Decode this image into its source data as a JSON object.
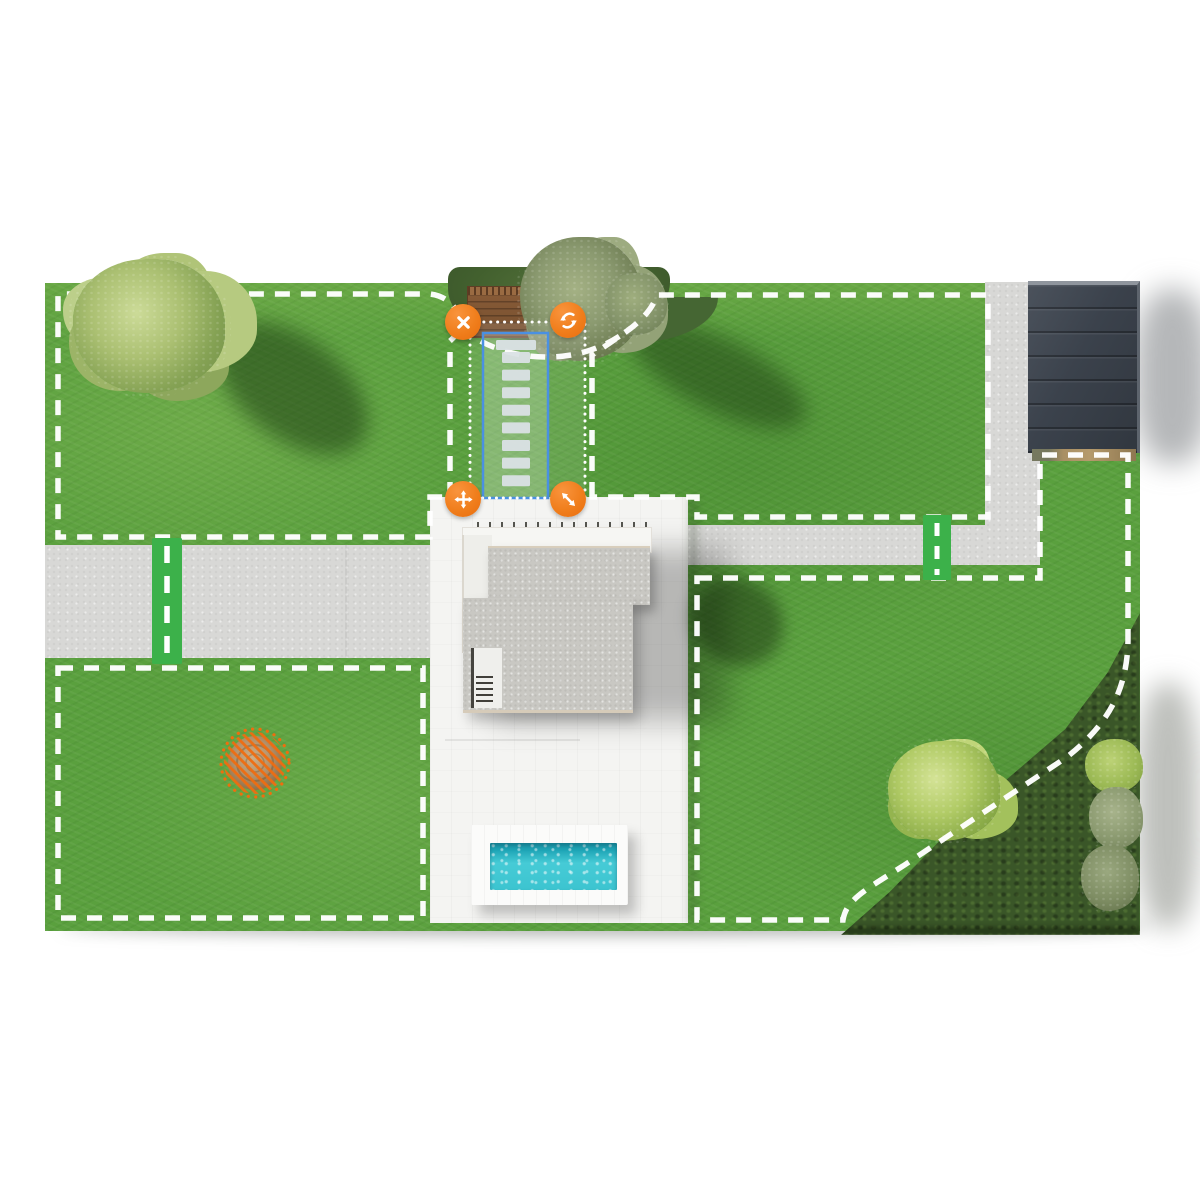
{
  "app": {
    "name": "robot-mower-garden-map",
    "view": "zone-editor"
  },
  "map": {
    "zones": [
      {
        "id": "zone-top-left",
        "type": "mowing-zone",
        "boundary_style": "white-dashed"
      },
      {
        "id": "zone-top-right",
        "type": "mowing-zone",
        "boundary_style": "white-dashed"
      },
      {
        "id": "zone-bottom-left",
        "type": "mowing-zone",
        "boundary_style": "white-dashed"
      },
      {
        "id": "zone-bottom-right",
        "type": "mowing-zone",
        "boundary_style": "white-dashed"
      }
    ],
    "passages": [
      {
        "id": "passage-west",
        "orientation": "vertical",
        "crosses": "left-walkway"
      },
      {
        "id": "passage-east",
        "orientation": "vertical",
        "crosses": "right-walkway"
      }
    ],
    "obstacle": {
      "id": "no-go-circle",
      "shape": "circle",
      "style": "orange-hatched"
    },
    "selection": {
      "id": "stepping-stone-zone",
      "shape": "rectangle",
      "stepping_stones": 9,
      "stone": {
        "x": 457,
        "y0": 69,
        "width": 28,
        "height": 11,
        "gap": 17.6,
        "top_width": 40
      },
      "handles": [
        {
          "icon": "close-icon",
          "action": "delete-zone"
        },
        {
          "icon": "rotate-icon",
          "action": "rotate-zone"
        },
        {
          "icon": "move-icon",
          "action": "move-zone"
        },
        {
          "icon": "resize-icon",
          "action": "resize-zone"
        }
      ]
    },
    "features": [
      "house",
      "patio",
      "pool",
      "garage",
      "walkways",
      "trees",
      "hedge"
    ]
  },
  "colors": {
    "accent_orange": "#ee6e0e",
    "selection_blue": "#4a90e2",
    "passage_green": "#3cb14a",
    "boundary_white": "#ffffff",
    "pool_water": "#3fc9d3",
    "grass_green": "#5aa03e",
    "stone_gray": "#d2dade"
  }
}
